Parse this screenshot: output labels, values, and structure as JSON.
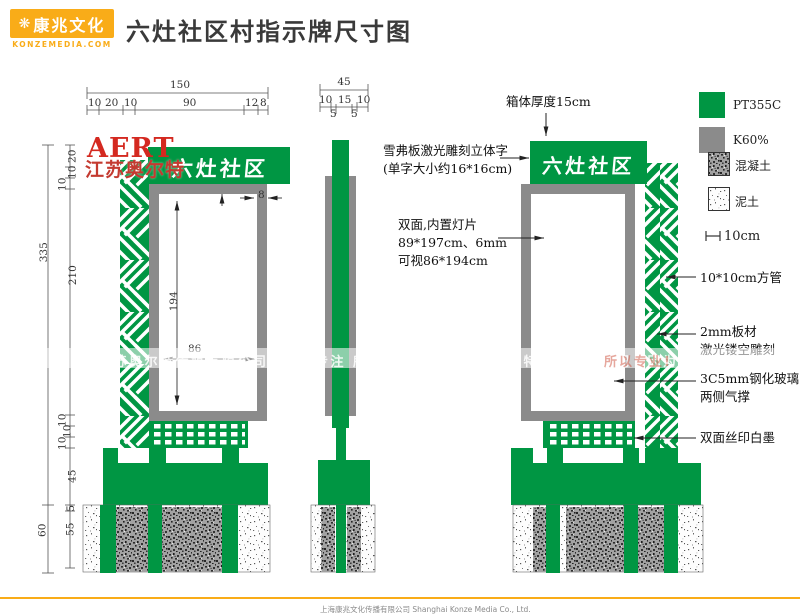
{
  "header": {
    "logo": {
      "icon": "❋",
      "name_cn": "康兆文化",
      "name_en": "KONZEMEDIA.COM"
    },
    "title": "六灶社区村指示牌尺寸图"
  },
  "sign": {
    "panel_text": "六灶社区"
  },
  "legend": {
    "items": [
      {
        "key": "green",
        "label": "PT355C"
      },
      {
        "key": "gray",
        "label": "K60%"
      },
      {
        "key": "concrete",
        "label": "混凝土"
      },
      {
        "key": "soil",
        "label": "泥土"
      }
    ],
    "scale_label": "10cm"
  },
  "dims": {
    "front_total_width": "150",
    "front_width_segs": [
      "10",
      "20",
      "10",
      "90",
      "12",
      "8"
    ],
    "front_total_height": "335",
    "front_underground": "60",
    "front_height_segs": [
      "20",
      "10",
      "10",
      "210",
      "10",
      "10",
      "10",
      "45",
      "5",
      "55"
    ],
    "panel_h": "194",
    "panel_w": "86",
    "frame_w": "8",
    "side_total_width": "45",
    "side_width_segs": [
      "10",
      "15",
      "10"
    ],
    "side_width_subsegs": [
      "5",
      "5"
    ]
  },
  "annotations": {
    "box_thickness": "箱体厚度15cm",
    "foam_letters_line1": "雪弗板激光雕刻立体字",
    "foam_letters_line2": "(单字大小约16*16cm)",
    "light_panel_line1": "双面,内置灯片",
    "light_panel_line2": "89*197cm、6mm",
    "light_panel_line3": "可视86*194cm",
    "square_tube": "10*10cm方管",
    "laser_cut_line1": "2mm板材",
    "laser_cut_line2": "激光镂空雕刻",
    "glass_line1": "3C5mm钢化玻璃",
    "glass_line2": "两侧气撑",
    "silk_print": "双面丝印白墨"
  },
  "watermark": {
    "brand_en": "AERT",
    "brand_cn": "江苏奥尔特",
    "band_text": "江苏奥尔特传媒有限公司　因为专注 所以专业　　　江苏奥尔特传媒有限公司　因为专注",
    "band_fragment": "所以专业!"
  },
  "footer": {
    "company": "上海康兆文化传播有限公司 Shanghai Konze Media Co., Ltd."
  },
  "colors": {
    "green": "#009643",
    "gray": "#8B8B8B",
    "amber": "#F9AC18",
    "red": "#D42920"
  }
}
